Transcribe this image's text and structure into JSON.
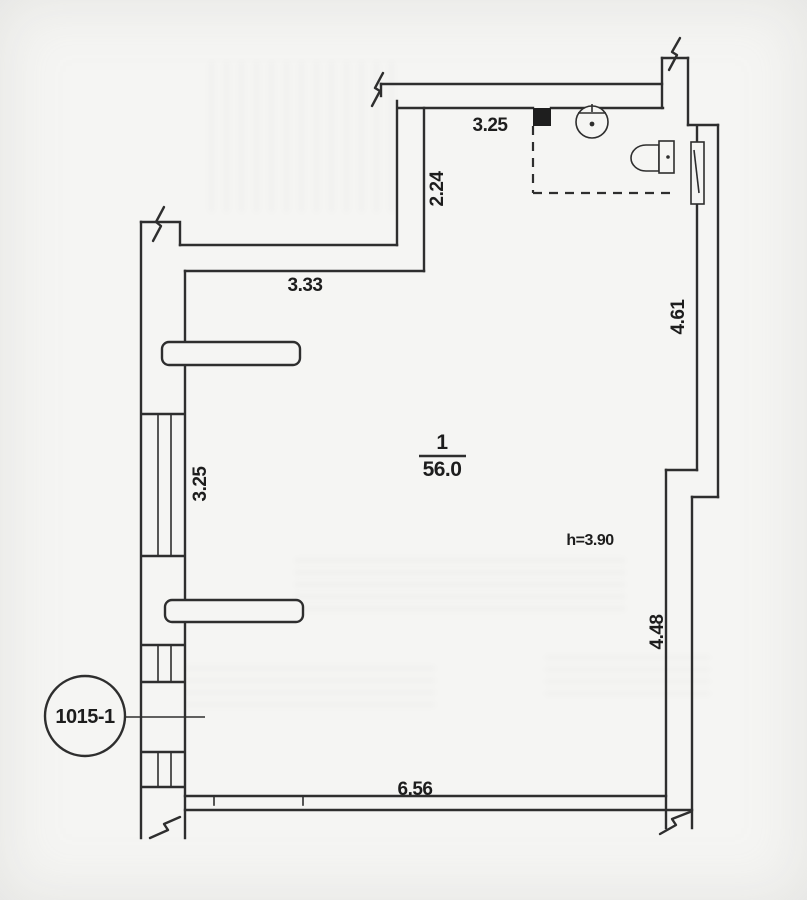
{
  "figure": {
    "type": "floor-plan",
    "unit_label": "1015-1",
    "room": {
      "number": "1",
      "area": "56.0",
      "ceiling_height": "h=3.90"
    },
    "dims": {
      "bath_width": "3.25",
      "entry_depth": "2.24",
      "upper_width": "3.33",
      "right_upper": "4.61",
      "left_wall": "3.25",
      "right_lower": "4.48",
      "bottom_width": "6.56"
    },
    "colors": {
      "paper": "#f5f5f3",
      "ink": "#2e2e2e",
      "text": "#1d1d1d"
    }
  }
}
